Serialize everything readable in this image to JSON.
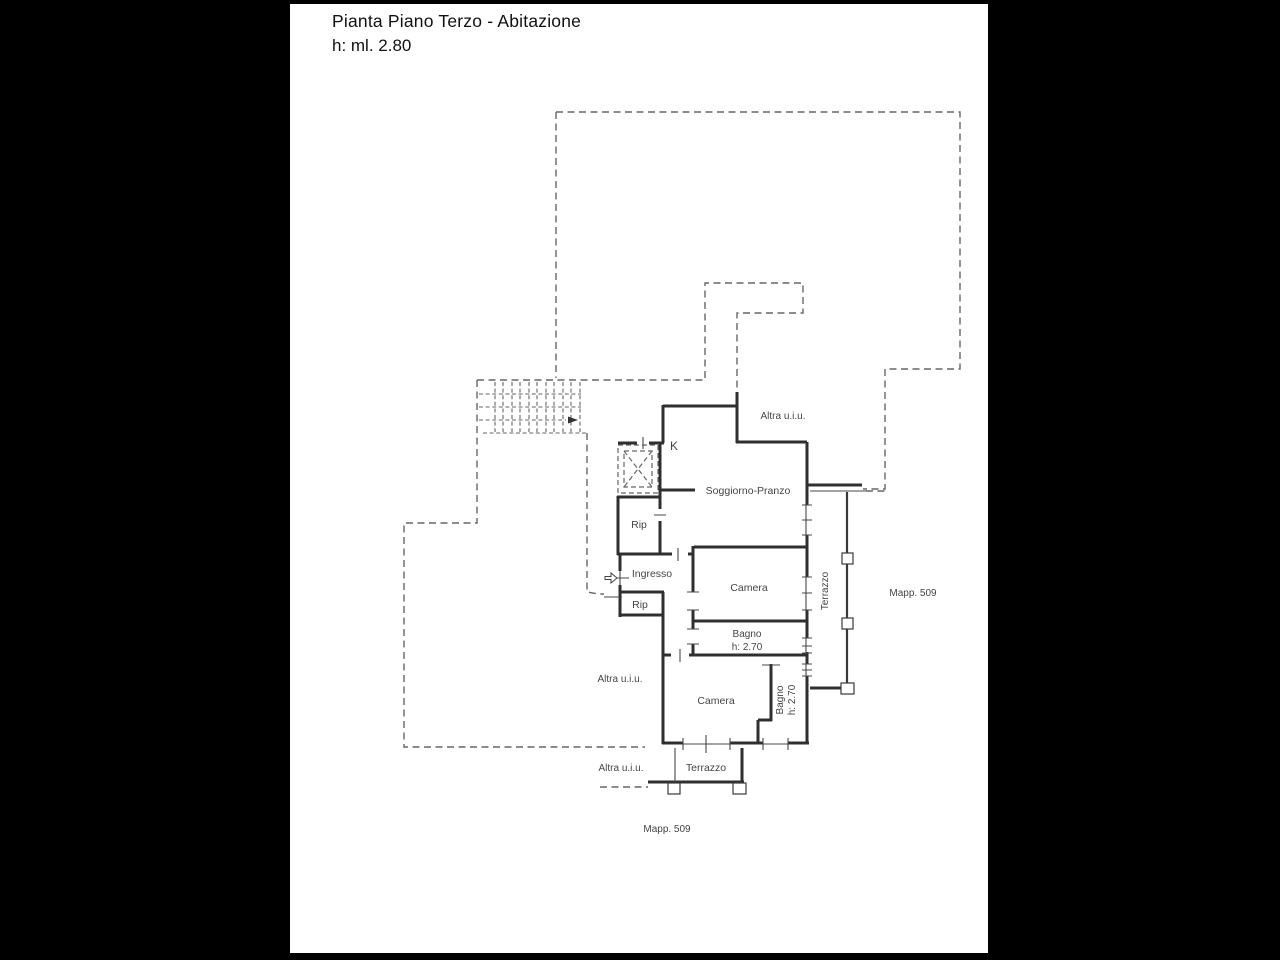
{
  "title": {
    "line1": "Pianta Piano Terzo - Abitazione",
    "line2": "h: ml. 2.80"
  },
  "plan": {
    "rooms": {
      "kitchen_mark": "K",
      "living": "Soggiorno-Pranzo",
      "storage1": "Rip",
      "entry": "Ingresso",
      "storage2": "Rip",
      "bedroom1": "Camera",
      "bath1_name": "Bagno",
      "bath1_height": "h: 2.70",
      "bedroom2": "Camera",
      "bath2_name": "Bagno",
      "bath2_height": "h: 2.70",
      "terrace_right": "Terrazzo",
      "terrace_bottom": "Terrazzo"
    },
    "adjacent_units": {
      "top": "Altra u.i.u.",
      "middle": "Altra u.i.u.",
      "bottom": "Altra u.i.u."
    },
    "parcels": {
      "right": "Mapp. 509",
      "bottom": "Mapp. 509"
    }
  },
  "colors": {
    "wall_ink": "#2f2f2f",
    "thin_ink": "#474747",
    "dashed_boundary": "#666666",
    "label_text": "#454545",
    "paper": "#ffffff",
    "frame": "#000000"
  }
}
